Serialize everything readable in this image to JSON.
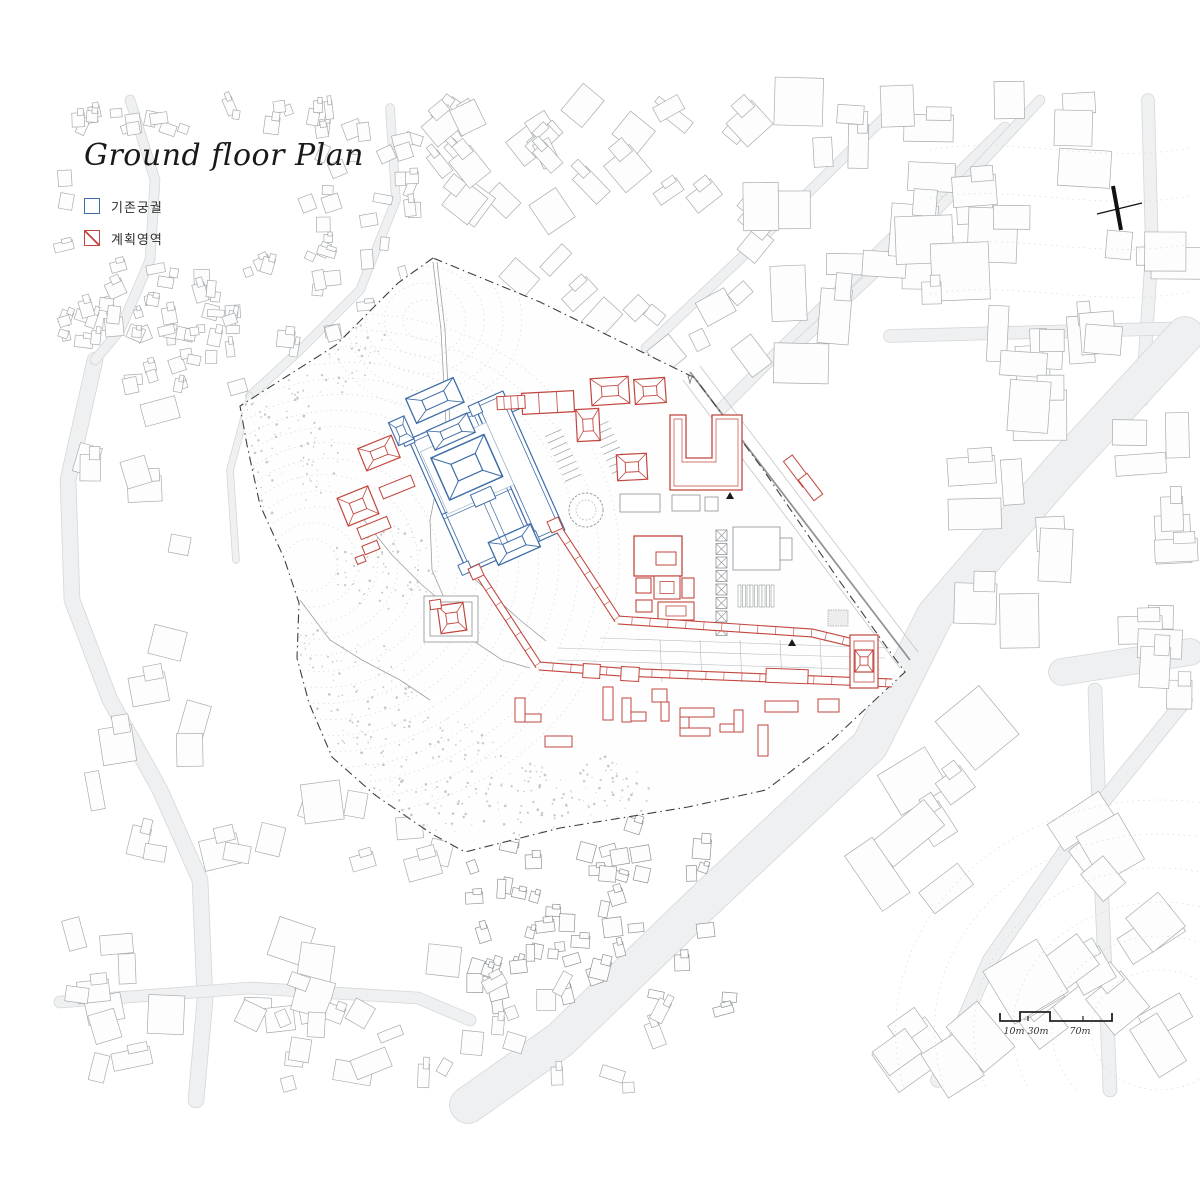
{
  "title": "Ground floor Plan",
  "legend": {
    "items": [
      {
        "label": "기존궁궐",
        "color": "#3f6da7"
      },
      {
        "label": "계획영역",
        "color": "#c2463e"
      }
    ]
  },
  "scale_bar": {
    "labels": [
      "10m",
      "30m",
      "70m"
    ]
  },
  "colors": {
    "existing_palace_blue": "#3f6da7",
    "planned_area_red": "#c2463e",
    "context_building_line": "#a7acb0",
    "road_fill": "#eef0f1",
    "road_edge": "#d4d7d9",
    "site_boundary": "#3f3f3f",
    "contour_dotted": "#ced3cf",
    "paper": "#ffffff"
  }
}
